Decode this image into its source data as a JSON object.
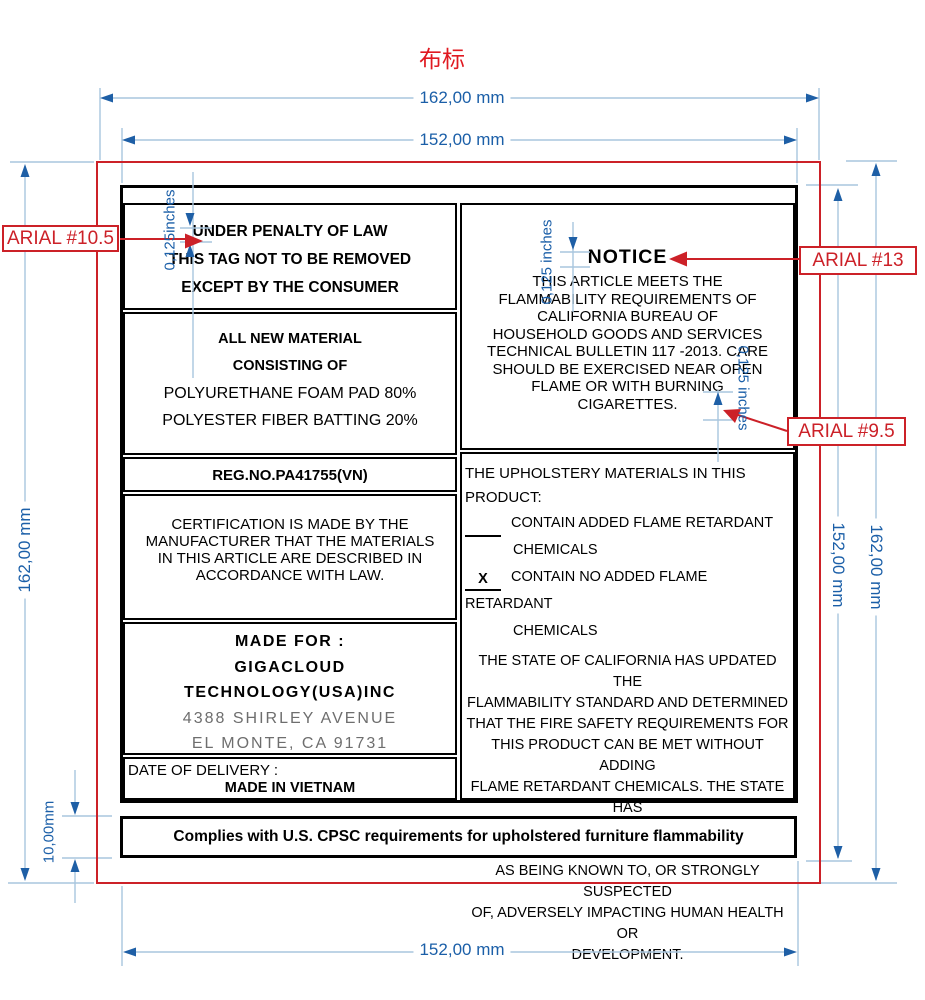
{
  "title": "布标",
  "dims": {
    "top_outer": "162,00 mm",
    "top_inner": "152,00 mm",
    "left_outer": "162,00 mm",
    "strip_height": "10,00mm",
    "right_inner": "152,00 mm",
    "right_outer": "162,00 mm",
    "bottom_inner": "152,00 mm",
    "inset_left": "0,125inches",
    "inset_notice": "0,125 inches",
    "inset_right": "0,125 inches"
  },
  "callouts": {
    "left": "ARIAL #10.5",
    "right_top": "ARIAL #13",
    "right_mid": "ARIAL #9.5"
  },
  "colors": {
    "dimension_blue": "#1b5fa8",
    "line_light_blue": "#a9c6de",
    "callout_red": "#cc2128",
    "address_gray": "#6e6e6e"
  },
  "label": {
    "penalty": {
      "lines": [
        "UNDER PENALTY OF LAW",
        "THIS TAG NOT TO BE REMOVED",
        "EXCEPT BY THE CONSUMER"
      ]
    },
    "materials": {
      "line1": "ALL NEW MATERIAL",
      "line2": "CONSISTING OF",
      "line3": "POLYURETHANE FOAM PAD 80%",
      "line4": "POLYESTER FIBER BATTING 20%"
    },
    "reg_no": "REG.NO.PA41755(VN)",
    "certification": {
      "lines": [
        "CERTIFICATION IS MADE BY THE",
        "MANUFACTURER THAT THE MATERIALS",
        "IN THIS ARTICLE ARE DESCRIBED IN",
        "ACCORDANCE WITH LAW."
      ]
    },
    "made_for": {
      "heading": "MADE FOR :",
      "company1": "GIGACLOUD",
      "company2": "TECHNOLOGY(USA)INC",
      "address1": "4388 SHIRLEY AVENUE",
      "address2": "EL MONTE, CA 91731"
    },
    "delivery": {
      "date_label": "DATE OF DELIVERY :",
      "origin": "MADE IN VIETNAM"
    },
    "notice": {
      "heading": "NOTICE",
      "lines": [
        "THIS ARTICLE MEETS THE",
        "FLAMMABILITY REQUIREMENTS OF",
        "CALIFORNIA BUREAU OF",
        "HOUSEHOLD GOODS AND SERVICES",
        "TECHNICAL BULLETIN 117 -2013. CARE",
        "SHOULD BE EXERCISED NEAR OPEN",
        "FLAME OR WITH BURNING",
        "CIGARETTES."
      ]
    },
    "upholstery": {
      "heading": "THE UPHOLSTERY MATERIALS IN THIS PRODUCT:",
      "options": [
        {
          "mark": "",
          "text1": "CONTAIN ADDED FLAME RETARDANT",
          "text2": "CHEMICALS"
        },
        {
          "mark": "X",
          "text1": "CONTAIN NO ADDED FLAME RETARDANT",
          "text2": "CHEMICALS"
        }
      ],
      "statement_lines": [
        "THE STATE OF CALIFORNIA HAS UPDATED THE",
        "FLAMMABILITY STANDARD AND DETERMINED",
        "THAT THE FIRE SAFETY REQUIREMENTS FOR",
        "THIS PRODUCT CAN BE MET WITHOUT ADDING",
        "FLAME RETARDANT CHEMICALS. THE STATE HAS",
        "IDENTIFIED MANY FLAME RETARDANT CHEMICALS",
        "AS BEING KNOWN TO, OR STRONGLY SUSPECTED",
        "OF, ADVERSELY IMPACTING HUMAN HEALTH OR",
        "DEVELOPMENT."
      ]
    },
    "compliance": "Complies with U.S. CPSC requirements for upholstered furniture flammability"
  }
}
